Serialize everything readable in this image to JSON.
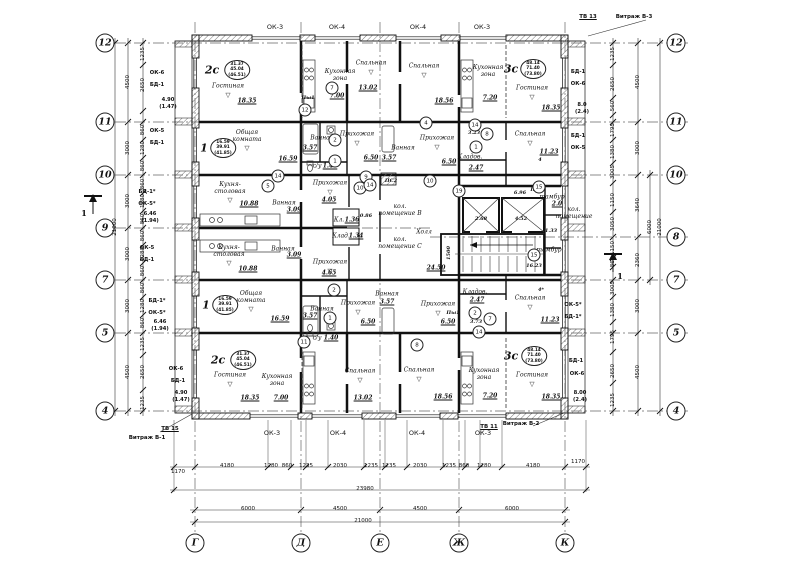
{
  "axis_circles": {
    "left": [
      {
        "n": "12",
        "y": 43
      },
      {
        "n": "11",
        "y": 122
      },
      {
        "n": "10",
        "y": 175
      },
      {
        "n": "9",
        "y": 228
      },
      {
        "n": "7",
        "y": 280
      },
      {
        "n": "5",
        "y": 333
      },
      {
        "n": "4",
        "y": 411
      }
    ],
    "right": [
      {
        "n": "12",
        "y": 43
      },
      {
        "n": "11",
        "y": 122
      },
      {
        "n": "10",
        "y": 175
      },
      {
        "n": "8",
        "y": 237
      },
      {
        "n": "7",
        "y": 280
      },
      {
        "n": "5",
        "y": 333
      },
      {
        "n": "4",
        "y": 411
      }
    ],
    "bottom": [
      {
        "n": "Г",
        "x": 195
      },
      {
        "n": "Д",
        "x": 301
      },
      {
        "n": "Е",
        "x": 380
      },
      {
        "n": "Ж",
        "x": 459
      },
      {
        "n": "К",
        "x": 565
      }
    ]
  },
  "windows": {
    "top": [
      {
        "t": "ОК-3",
        "x": 275
      },
      {
        "t": "ОК-4",
        "x": 337
      },
      {
        "t": "ОК-4",
        "x": 418
      },
      {
        "t": "ОК-3",
        "x": 482
      }
    ],
    "bottom": [
      {
        "t": "ОК-3",
        "x": 272
      },
      {
        "t": "ОК-4",
        "x": 338
      },
      {
        "t": "ОК-4",
        "x": 417
      },
      {
        "t": "ОК-3",
        "x": 483
      }
    ]
  },
  "glazing": [
    {
      "t": "ТВ 13",
      "x": 588,
      "y": 17,
      "u": 1
    },
    {
      "t": "Витраж В-3",
      "x": 634,
      "y": 17
    },
    {
      "t": "ТВ 15",
      "x": 170,
      "y": 429,
      "u": 1
    },
    {
      "t": "Витраж В-1",
      "x": 147,
      "y": 438
    },
    {
      "t": "ТВ 11",
      "x": 489,
      "y": 427,
      "u": 1
    },
    {
      "t": "Витраж В-2",
      "x": 521,
      "y": 424
    }
  ],
  "side_labels": {
    "left": [
      [
        "ОК-6",
        157,
        73
      ],
      [
        "БД-1",
        157,
        85
      ],
      [
        "4.90",
        168,
        100
      ],
      [
        "(1.47)",
        168,
        107
      ],
      [
        "ОК-5",
        157,
        131
      ],
      [
        "БД-1",
        157,
        143
      ],
      [
        "БД-1*",
        147,
        192
      ],
      [
        "ОК-5*",
        147,
        204
      ],
      [
        "6.46",
        150,
        214
      ],
      [
        "(1.94)",
        150,
        221
      ],
      [
        "ОК-5",
        147,
        248
      ],
      [
        "БД-1",
        147,
        260
      ],
      [
        "БД-1*",
        157,
        301
      ],
      [
        "ОК-5*",
        157,
        313
      ],
      [
        "6.46",
        160,
        322
      ],
      [
        "(1.94)",
        160,
        329
      ],
      [
        "ОК-6",
        176,
        369
      ],
      [
        "БД-1",
        178,
        381
      ],
      [
        "4.90",
        181,
        393
      ],
      [
        "(1.47)",
        181,
        400
      ]
    ],
    "right": [
      [
        "БД-1",
        578,
        72
      ],
      [
        "ОК-6",
        578,
        84
      ],
      [
        "8.0",
        582,
        105
      ],
      [
        "(2.4)",
        582,
        112
      ],
      [
        "БД-1",
        578,
        136
      ],
      [
        "ОК-5",
        578,
        148
      ],
      [
        "ОК-5*",
        573,
        305
      ],
      [
        "БД-1*",
        573,
        317
      ],
      [
        "БД-1",
        576,
        361
      ],
      [
        "ОК-6",
        577,
        374
      ],
      [
        "8.00",
        580,
        393
      ],
      [
        "(2.4)",
        580,
        400
      ]
    ]
  },
  "stamps": [
    {
      "id": "2с",
      "v": [
        "31.37",
        "45.04",
        "(46.51)"
      ],
      "ix": 212,
      "iy": 70,
      "ox": 237,
      "oy": 70
    },
    {
      "id": "1",
      "v": [
        "16.59",
        "39.91",
        "(41.85)"
      ],
      "ix": 204,
      "iy": 148,
      "ox": 223,
      "oy": 148
    },
    {
      "id": "3с",
      "v": [
        "48.14",
        "71.40",
        "(73.80)"
      ],
      "ix": 511,
      "iy": 69,
      "ox": 533,
      "oy": 69
    },
    {
      "id": "1",
      "v": [
        "16.59",
        "39.91",
        "(41.85)"
      ],
      "ix": 206,
      "iy": 305,
      "ox": 225,
      "oy": 305
    },
    {
      "id": "2с",
      "v": [
        "31.37",
        "45.04",
        "(46.51)"
      ],
      "ix": 218,
      "iy": 360,
      "ox": 243,
      "oy": 360
    },
    {
      "id": "3с",
      "v": [
        "48.14",
        "71.40",
        "(73.80)"
      ],
      "ix": 511,
      "iy": 356,
      "ox": 534,
      "oy": 356
    }
  ],
  "rooms": [
    {
      "n": "Гостиная",
      "nx": 228,
      "ny": 86,
      "a": "18.35",
      "ax": 247,
      "ay": 101,
      "t": 1
    },
    {
      "n": "Кухонная\nзона",
      "nx": 340,
      "ny": 75,
      "a": "7.00",
      "ax": 337,
      "ay": 96
    },
    {
      "n": "Спальная",
      "nx": 371,
      "ny": 63,
      "a": "13.02",
      "ax": 368,
      "ay": 88,
      "t": 1
    },
    {
      "n": "Спальная",
      "nx": 424,
      "ny": 66,
      "a": "18.56",
      "ax": 444,
      "ay": 101,
      "t": 1
    },
    {
      "n": "Кухонная\nзона",
      "nx": 488,
      "ny": 71,
      "a": "7.20",
      "ax": 490,
      "ay": 98
    },
    {
      "n": "Гостиная",
      "nx": 532,
      "ny": 88,
      "a": "18.35",
      "ax": 551,
      "ay": 108,
      "t": 1
    },
    {
      "n": "Общая\nкомната",
      "nx": 247,
      "ny": 136,
      "a": "16.59",
      "ax": 288,
      "ay": 159,
      "t": 1
    },
    {
      "n": "Ванная",
      "nx": 322,
      "ny": 138,
      "a": "3.57",
      "ax": 310,
      "ay": 148
    },
    {
      "n": "Прихожая",
      "nx": 357,
      "ny": 134,
      "a": "6.50",
      "ax": 371,
      "ay": 158,
      "t": 1
    },
    {
      "n": "с/у",
      "nx": 317,
      "ny": 166,
      "a": "1.40",
      "ax": 330,
      "ay": 166
    },
    {
      "n": "Ванная",
      "nx": 403,
      "ny": 148,
      "a": "3.57",
      "ax": 389,
      "ay": 158
    },
    {
      "n": "Прихожая",
      "nx": 437,
      "ny": 138,
      "a": "6.50",
      "ax": 449,
      "ay": 162,
      "t": 1
    },
    {
      "n": "Кладов.",
      "nx": 470,
      "ny": 157,
      "a": "2.47",
      "ax": 476,
      "ay": 168
    },
    {
      "n": "Спальная",
      "nx": 530,
      "ny": 134,
      "a": "11.23",
      "ax": 549,
      "ay": 152,
      "t": 1
    },
    {
      "n": "Кухня-\nстоловая",
      "nx": 230,
      "ny": 188,
      "a": "10.88",
      "ax": 249,
      "ay": 204,
      "t": 1
    },
    {
      "n": "Ванная",
      "nx": 284,
      "ny": 203,
      "a": "3.09",
      "ax": 294,
      "ay": 210
    },
    {
      "n": "Прихожая",
      "nx": 330,
      "ny": 183,
      "a": "4.05",
      "ax": 329,
      "ay": 200,
      "t": 1
    },
    {
      "n": "Кл.",
      "nx": 339,
      "ny": 220,
      "a": "1.36",
      "ax": 352,
      "ay": 220
    },
    {
      "n": "Клад.",
      "nx": 341,
      "ny": 236,
      "a": "1.34",
      "ax": 356,
      "ay": 236
    },
    {
      "n": "кол.\nпомещение В",
      "nx": 400,
      "ny": 210
    },
    {
      "n": "кол.\nпомещение С",
      "nx": 400,
      "ny": 243
    },
    {
      "n": "Холл",
      "nx": 424,
      "ny": 232,
      "a": "24.50",
      "ax": 436,
      "ay": 268
    },
    {
      "n": "тамбур",
      "nx": 552,
      "ny": 197,
      "a": "2.0",
      "ax": 557,
      "ay": 204
    },
    {
      "n": "кол.\nпомещение",
      "nx": 574,
      "ny": 213
    },
    {
      "n": "тамбур",
      "nx": 549,
      "ny": 250
    },
    {
      "n": "Кухня-\nстоловая",
      "nx": 229,
      "ny": 251,
      "a": "10.88",
      "ax": 248,
      "ay": 269,
      "t": 1
    },
    {
      "n": "Ванная",
      "nx": 283,
      "ny": 249,
      "a": "3.09",
      "ax": 294,
      "ay": 255
    },
    {
      "n": "Прихожая",
      "nx": 330,
      "ny": 262,
      "a": "4.65",
      "ax": 329,
      "ay": 273,
      "t": 1
    },
    {
      "n": "Общая\nкомната",
      "nx": 251,
      "ny": 297,
      "a": "16.59",
      "ax": 280,
      "ay": 319,
      "t": 1
    },
    {
      "n": "Ванная",
      "nx": 322,
      "ny": 309,
      "a": "3.57",
      "ax": 310,
      "ay": 316
    },
    {
      "n": "Прихожая",
      "nx": 358,
      "ny": 303,
      "a": "6.50",
      "ax": 368,
      "ay": 322,
      "t": 1
    },
    {
      "n": "с/у",
      "nx": 317,
      "ny": 338,
      "a": "1.40",
      "ax": 331,
      "ay": 338
    },
    {
      "n": "Ванная",
      "nx": 387,
      "ny": 294,
      "a": "3.57",
      "ax": 387,
      "ay": 302
    },
    {
      "n": "Прихожая",
      "nx": 438,
      "ny": 304,
      "a": "6.50",
      "ax": 448,
      "ay": 322,
      "t": 1
    },
    {
      "n": "Кладов.",
      "nx": 475,
      "ny": 292,
      "a": "2.47",
      "ax": 477,
      "ay": 300
    },
    {
      "n": "Спальная",
      "nx": 530,
      "ny": 298,
      "a": "11.23",
      "ax": 550,
      "ay": 320,
      "t": 1
    },
    {
      "n": "Гостиная",
      "nx": 230,
      "ny": 375,
      "a": "18.35",
      "ax": 250,
      "ay": 398,
      "t": 1
    },
    {
      "n": "Кухонная\nзона",
      "nx": 277,
      "ny": 380,
      "a": "7.00",
      "ax": 281,
      "ay": 398
    },
    {
      "n": "Спальная",
      "nx": 360,
      "ny": 371,
      "a": "13.02",
      "ax": 363,
      "ay": 398,
      "t": 1
    },
    {
      "n": "Спальная",
      "nx": 419,
      "ny": 370,
      "a": "18.56",
      "ax": 443,
      "ay": 397,
      "t": 1
    },
    {
      "n": "Кухонная\nзона",
      "nx": 484,
      "ny": 374,
      "a": "7.20",
      "ax": 490,
      "ay": 396
    },
    {
      "n": "Гостиная",
      "nx": 532,
      "ny": 375,
      "a": "18.35",
      "ax": 551,
      "ay": 397,
      "t": 1
    }
  ],
  "labels_small": [
    {
      "t": "3.23",
      "x": 474,
      "y": 133
    },
    {
      "t": "0.86",
      "x": 366,
      "y": 216
    },
    {
      "t": "3.73",
      "x": 476,
      "y": 322
    },
    {
      "t": "2.68",
      "x": 481,
      "y": 219
    },
    {
      "t": "4.52",
      "x": 521,
      "y": 219
    },
    {
      "t": "16.23",
      "x": 534,
      "y": 266
    },
    {
      "t": "6.96",
      "x": 520,
      "y": 193
    },
    {
      "t": "1.33",
      "x": 551,
      "y": 231
    },
    {
      "t": "ПС2",
      "x": 391,
      "y": 181
    },
    {
      "t": "Пы1",
      "x": 308,
      "y": 98
    },
    {
      "t": "Пы3",
      "x": 537,
      "y": 190
    },
    {
      "t": "Пы1",
      "x": 453,
      "y": 313
    },
    {
      "t": "4",
      "x": 540,
      "y": 160
    },
    {
      "t": "4*",
      "x": 541,
      "y": 290
    },
    {
      "t": "1500",
      "x": 449,
      "y": 253,
      "r": 1
    }
  ],
  "callouts": [
    {
      "t": "7",
      "x": 332,
      "y": 88
    },
    {
      "t": "12",
      "x": 305,
      "y": 110
    },
    {
      "t": "2",
      "x": 335,
      "y": 140
    },
    {
      "t": "1",
      "x": 335,
      "y": 161
    },
    {
      "t": "14",
      "x": 278,
      "y": 176
    },
    {
      "t": "5",
      "x": 268,
      "y": 186
    },
    {
      "t": "4",
      "x": 426,
      "y": 123
    },
    {
      "t": "14",
      "x": 475,
      "y": 125
    },
    {
      "t": "8",
      "x": 487,
      "y": 134
    },
    {
      "t": "1",
      "x": 476,
      "y": 147
    },
    {
      "t": "9",
      "x": 366,
      "y": 177
    },
    {
      "t": "10",
      "x": 360,
      "y": 188
    },
    {
      "t": "19",
      "x": 459,
      "y": 191
    },
    {
      "t": "10",
      "x": 430,
      "y": 181
    },
    {
      "t": "15",
      "x": 534,
      "y": 255
    },
    {
      "t": "15",
      "x": 539,
      "y": 187
    },
    {
      "t": "14",
      "x": 370,
      "y": 185
    },
    {
      "t": "2",
      "x": 334,
      "y": 290
    },
    {
      "t": "1",
      "x": 330,
      "y": 318
    },
    {
      "t": "11",
      "x": 304,
      "y": 342
    },
    {
      "t": "2",
      "x": 475,
      "y": 313
    },
    {
      "t": "7",
      "x": 490,
      "y": 319
    },
    {
      "t": "14",
      "x": 479,
      "y": 332
    },
    {
      "t": "8",
      "x": 417,
      "y": 345
    }
  ],
  "dims": {
    "left_sub": {
      "x": 143,
      "items": [
        [
          "1235",
          54
        ],
        [
          "2650",
          85
        ],
        [
          "860",
          130
        ],
        [
          "1280",
          148
        ],
        [
          "860",
          166
        ],
        [
          "860",
          184
        ],
        [
          "1280",
          201
        ],
        [
          "860",
          219
        ],
        [
          "860",
          236
        ],
        [
          "1280",
          254
        ],
        [
          "860",
          271
        ],
        [
          "860",
          288
        ],
        [
          "1280",
          306
        ],
        [
          "860",
          323
        ],
        [
          "1235",
          344
        ],
        [
          "2650",
          372
        ],
        [
          "1235",
          403
        ]
      ]
    },
    "left_main": {
      "x": 128,
      "items": [
        [
          "4500",
          82
        ],
        [
          "3000",
          148
        ],
        [
          "3000",
          201
        ],
        [
          "3000",
          254
        ],
        [
          "3000",
          306
        ],
        [
          "4500",
          372
        ]
      ]
    },
    "left_total": {
      "x": 115,
      "items": [
        [
          "21000",
          227
        ]
      ]
    },
    "right_sub": {
      "x": 613,
      "items": [
        [
          "1235",
          54
        ],
        [
          "2650",
          84
        ],
        [
          "560",
          106
        ],
        [
          "1795",
          130
        ],
        [
          "1380",
          152
        ],
        [
          "3005",
          172
        ],
        [
          "1150",
          200
        ],
        [
          "3050",
          224
        ],
        [
          "1150",
          248
        ],
        [
          "865",
          262
        ],
        [
          "3005",
          288
        ],
        [
          "1380",
          310
        ],
        [
          "1795",
          337
        ],
        [
          "2650",
          371
        ],
        [
          "1235",
          400
        ]
      ]
    },
    "right_main": {
      "x": 638,
      "items": [
        [
          "4500",
          82
        ],
        [
          "3000",
          148
        ],
        [
          "3640",
          205
        ],
        [
          "2360",
          260
        ],
        [
          "3000",
          306
        ],
        [
          "4500",
          372
        ]
      ]
    },
    "right_6000": {
      "x": 650,
      "items": [
        [
          "6000",
          227
        ]
      ]
    },
    "right_total": {
      "x": 660,
      "items": [
        [
          "21000",
          227
        ]
      ]
    },
    "bottom_sub": {
      "y": 466,
      "items": [
        [
          "1170",
          178,
          472
        ],
        [
          "4180",
          227
        ],
        [
          "1280",
          271
        ],
        [
          "860",
          287
        ],
        [
          "1235",
          306
        ],
        [
          "2030",
          340
        ],
        [
          "1235",
          371
        ],
        [
          "1235",
          389
        ],
        [
          "2030",
          420
        ],
        [
          "1235",
          449
        ],
        [
          "860",
          464
        ],
        [
          "1280",
          484
        ],
        [
          "4180",
          533
        ],
        [
          "1170",
          578,
          462
        ]
      ]
    },
    "bottom_ovr": {
      "y": 489,
      "items": [
        [
          "23980",
          365
        ]
      ]
    },
    "bottom_main": {
      "y": 509,
      "items": [
        [
          "6000",
          248
        ],
        [
          "4500",
          340
        ],
        [
          "4500",
          420
        ],
        [
          "6000",
          512
        ]
      ]
    },
    "bottom_total": {
      "y": 521,
      "items": [
        [
          "21000",
          363
        ]
      ]
    }
  },
  "section_marks": [
    {
      "t": "1"
    },
    {
      "t": "1"
    }
  ]
}
